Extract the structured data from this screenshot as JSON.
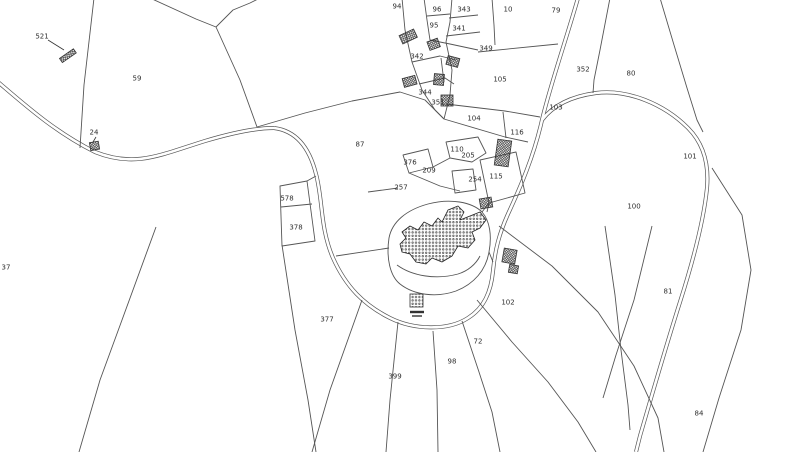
{
  "map": {
    "title": "cadastral-parcel-map",
    "background_color": "#ffffff",
    "boundary_line_color": "#555555",
    "road_casing_color": "#555555",
    "road_fill_color": "#ffffff",
    "building_hatch_color": "#333333",
    "label_color": "#2e2e2e",
    "parcel_labels": [
      {
        "t": "521",
        "x": 42,
        "y": 36
      },
      {
        "t": "59",
        "x": 137,
        "y": 78
      },
      {
        "t": "24",
        "x": 94,
        "y": 132
      },
      {
        "t": "37",
        "x": 6,
        "y": 267
      },
      {
        "t": "94",
        "x": 397,
        "y": 6
      },
      {
        "t": "96",
        "x": 437,
        "y": 9
      },
      {
        "t": "343",
        "x": 464,
        "y": 9
      },
      {
        "t": "10",
        "x": 508,
        "y": 9
      },
      {
        "t": "79",
        "x": 556,
        "y": 10
      },
      {
        "t": "95",
        "x": 434,
        "y": 25
      },
      {
        "t": "341",
        "x": 459,
        "y": 28
      },
      {
        "t": "342",
        "x": 417,
        "y": 56
      },
      {
        "t": "349",
        "x": 486,
        "y": 48
      },
      {
        "t": "344",
        "x": 425,
        "y": 92
      },
      {
        "t": "351",
        "x": 438,
        "y": 102
      },
      {
        "t": "105",
        "x": 500,
        "y": 79
      },
      {
        "t": "352",
        "x": 583,
        "y": 69
      },
      {
        "t": "80",
        "x": 631,
        "y": 73
      },
      {
        "t": "103",
        "x": 556,
        "y": 107
      },
      {
        "t": "104",
        "x": 474,
        "y": 118
      },
      {
        "t": "116",
        "x": 517,
        "y": 132
      },
      {
        "t": "110",
        "x": 457,
        "y": 149
      },
      {
        "t": "205",
        "x": 468,
        "y": 155
      },
      {
        "t": "376",
        "x": 410,
        "y": 162
      },
      {
        "t": "209",
        "x": 429,
        "y": 170
      },
      {
        "t": "257",
        "x": 401,
        "y": 187
      },
      {
        "t": "254",
        "x": 475,
        "y": 179
      },
      {
        "t": "115",
        "x": 496,
        "y": 176
      },
      {
        "t": "87",
        "x": 360,
        "y": 144
      },
      {
        "t": "578",
        "x": 287,
        "y": 198
      },
      {
        "t": "378",
        "x": 296,
        "y": 227
      },
      {
        "t": "101",
        "x": 690,
        "y": 156
      },
      {
        "t": "100",
        "x": 634,
        "y": 206
      },
      {
        "t": "81",
        "x": 668,
        "y": 291
      },
      {
        "t": "102",
        "x": 508,
        "y": 302
      },
      {
        "t": "377",
        "x": 327,
        "y": 319
      },
      {
        "t": "72",
        "x": 478,
        "y": 341
      },
      {
        "t": "98",
        "x": 452,
        "y": 361
      },
      {
        "t": "399",
        "x": 395,
        "y": 376
      },
      {
        "t": "84",
        "x": 699,
        "y": 413
      }
    ]
  }
}
